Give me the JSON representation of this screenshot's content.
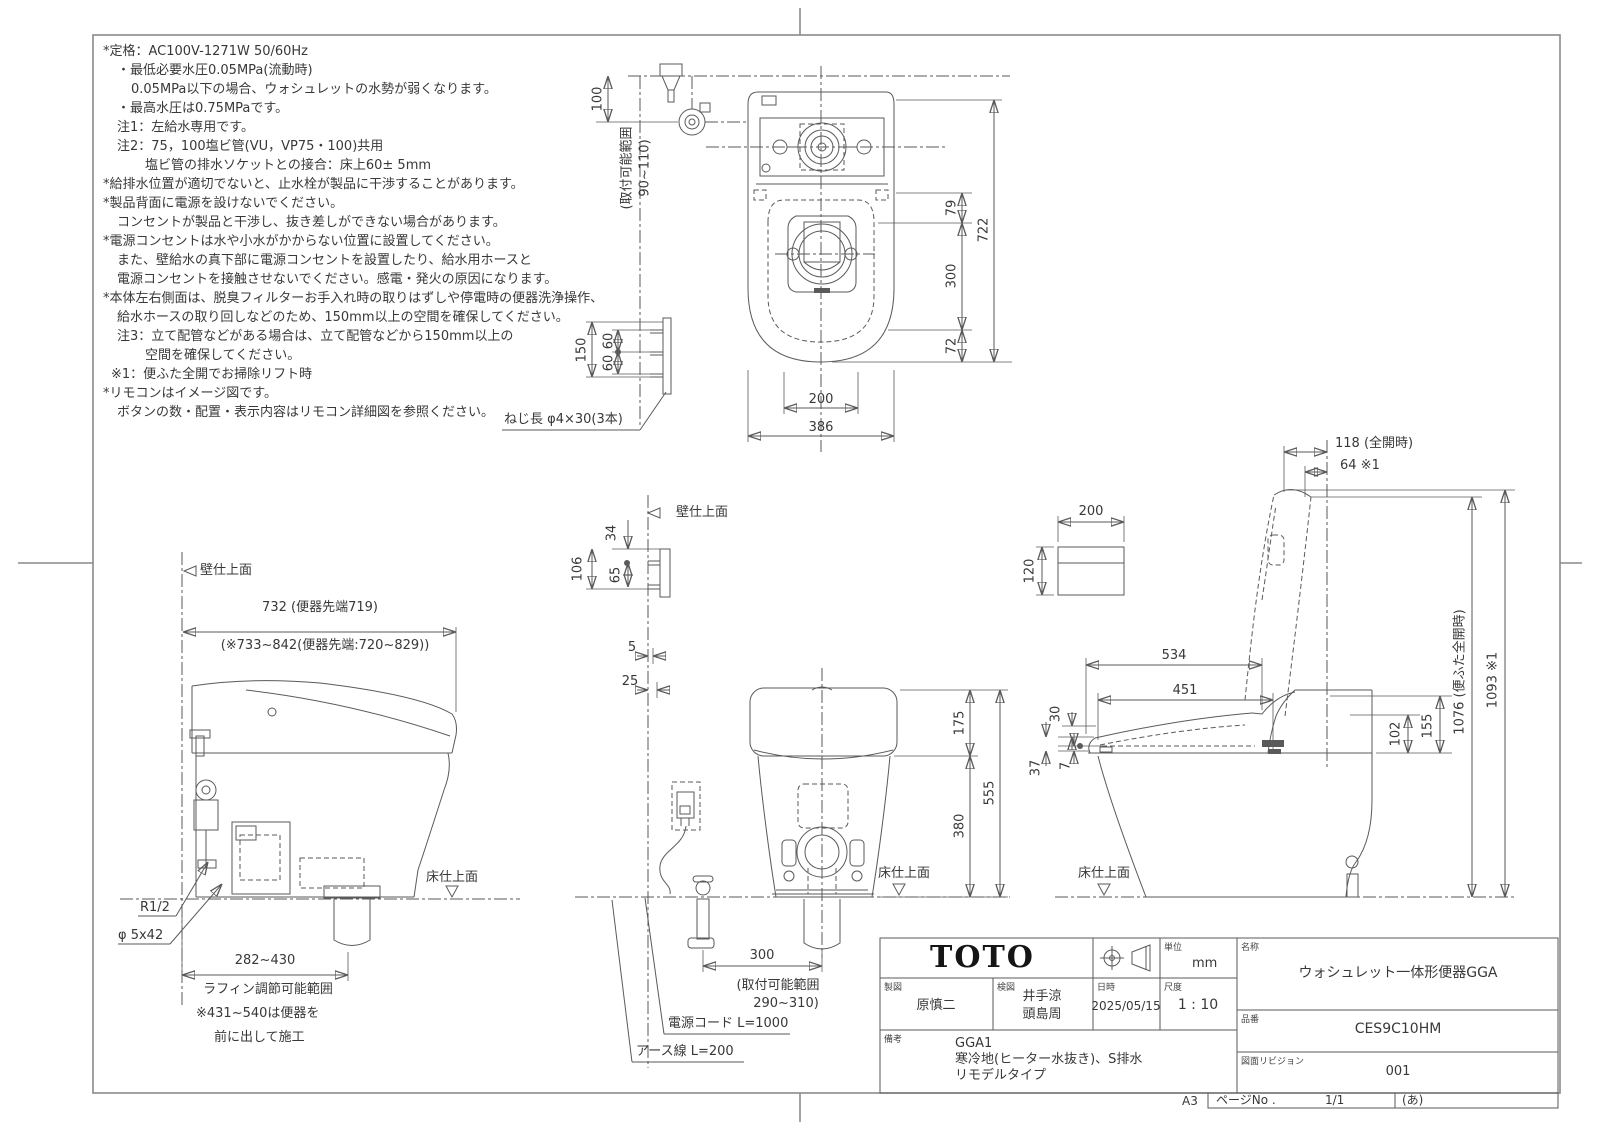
{
  "notes": {
    "lines": [
      "*定格：AC100V-1271W 50/60Hz",
      "・最低必要水圧0.05MPa(流動時)",
      "0.05MPa以下の場合、ウォシュレットの水勢が弱くなります。",
      "・最高水圧は0.75MPaです。",
      "注1：左給水専用です。",
      "注2：75，100塩ビ管(VU，VP75・100)共用",
      "塩ビ管の排水ソケットとの接合：床上60± 5mm",
      "*給排水位置が適切でないと、止水栓が製品に干渉することがあります。",
      "*製品背面に電源を設けないでください。",
      "コンセントが製品と干渉し、抜き差しができない場合があります。",
      "*電源コンセントは水や小水がかからない位置に設置してください。",
      "また、壁給水の真下部に電源コンセントを設置したり、給水用ホースと",
      "電源コンセントを接触させないでください。感電・発火の原因になります。",
      "*本体左右側面は、脱臭フィルターお手入れ時の取りはずしや停電時の便器洗浄操作、",
      "給水ホースの取り回しなどのため、150mm以上の空間を確保してください。",
      "注3：立て配管などがある場合は、立て配管などから150mm以上の",
      "空間を確保してください。",
      "※1：便ふた全開でお掃除リフト時",
      "*リモコンはイメージ図です。",
      "ボタンの数・配置・表示内容はリモコン詳細図を参照ください。"
    ]
  },
  "plan": {
    "dim_100": "100",
    "range_line1": "(取付可能範囲",
    "range_line2": "90~110)",
    "dim_79": "79",
    "dim_300": "300",
    "dim_72": "72",
    "dim_722": "722",
    "dim_200": "200",
    "dim_386": "386",
    "dim_150": "150",
    "dim_60a": "60",
    "dim_60b": "60",
    "screw_note": "ねじ長 φ4×30(3本)"
  },
  "left_view": {
    "wall_label": "壁仕上面",
    "dim_depth": "732 (便器先端719)",
    "dim_depth_alt": "(※733~842(便器先端:720~829))",
    "thread": "R1/2",
    "screw": "φ 5x42",
    "floor_label": "床仕上面",
    "dim_rough_in": "282~430",
    "rough_in_label": "ラフィン調節可能範囲",
    "rough_in_note1": "※431~540は便器を",
    "rough_in_note2": "前に出して施工"
  },
  "rear_view": {
    "wall_label": "壁仕上面",
    "dim_34": "34",
    "dim_106": "106",
    "dim_65": "65",
    "dim_5": "5",
    "dim_25": "25",
    "dim_175": "175",
    "dim_380": "380",
    "dim_555": "555",
    "dim_300": "300",
    "range1": "(取付可能範囲",
    "range2": "290~310)",
    "cord": "電源コード L=1000",
    "earth": "アース線 L=200",
    "floor_label": "床仕上面"
  },
  "right_view": {
    "dim_118": "118 (全開時)",
    "dim_64": "64 ※1",
    "dim_200": "200",
    "dim_120": "120",
    "dim_534": "534",
    "dim_451": "451",
    "dim_30": "30",
    "dim_37": "37",
    "dim_7": "7",
    "dim_102": "102",
    "dim_155": "155",
    "dim_1076": "1076 (便ふた全開時)",
    "dim_1093": "1093 ※1",
    "floor_label": "床仕上面"
  },
  "title_block": {
    "logo": "TOTO",
    "unit_label": "単位",
    "unit": "mm",
    "drafter_label": "製図",
    "drafter": "原慎二",
    "checker_label": "検図",
    "checker1": "井手涼",
    "checker2": "頭島周",
    "date_label": "日時",
    "date": "2025/05/15",
    "scale_label": "尺度",
    "scale": "1 : 10",
    "remarks_label": "備考",
    "remarks1": "GGA1",
    "remarks2": "寒冷地(ヒーター水抜き)、S排水",
    "remarks3": "リモデルタイプ",
    "name_label": "名称",
    "name": "ウォシュレット一体形便器GGA",
    "part_label": "品番",
    "part_no": "CES9C10HM",
    "rev_label": "図面リビジョン",
    "revision": "001",
    "page_label": "ページNo .",
    "page": "1/1",
    "page_note": "(あ)",
    "sheet": "A3"
  }
}
